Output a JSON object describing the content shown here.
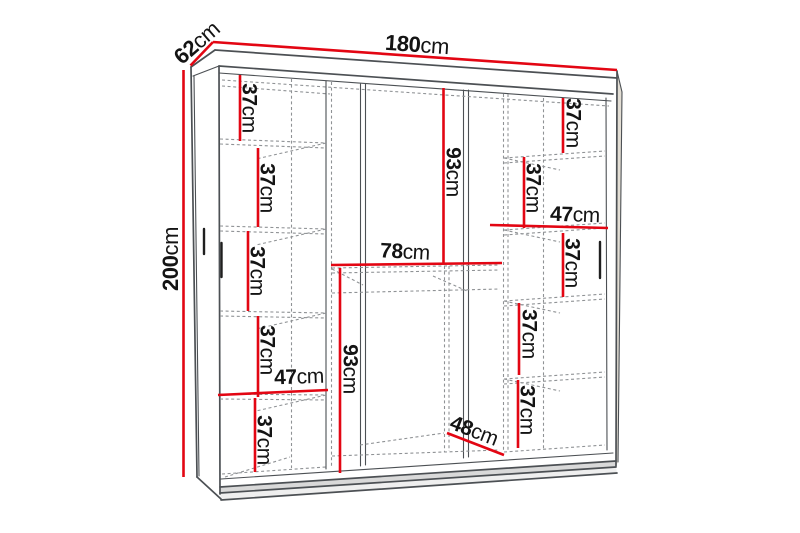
{
  "colors": {
    "dimension_line": "#e30613",
    "outline": "#4c5054",
    "hidden_line": "#8f9295",
    "text": "#141414",
    "background": "#ffffff",
    "handle": "#1f1f1f"
  },
  "dims": {
    "width180": {
      "num": "180",
      "unit": "cm"
    },
    "depth62": {
      "num": "62",
      "unit": "cm"
    },
    "height200": {
      "num": "200",
      "unit": "cm"
    },
    "l37_1": {
      "num": "37",
      "unit": "cm"
    },
    "l37_2": {
      "num": "37",
      "unit": "cm"
    },
    "l37_3": {
      "num": "37",
      "unit": "cm"
    },
    "l37_4": {
      "num": "37",
      "unit": "cm"
    },
    "l47": {
      "num": "47",
      "unit": "cm"
    },
    "l37_5": {
      "num": "37",
      "unit": "cm"
    },
    "m93_top": {
      "num": "93",
      "unit": "cm"
    },
    "m78": {
      "num": "78",
      "unit": "cm"
    },
    "m93_bottom": {
      "num": "93",
      "unit": "cm"
    },
    "m48": {
      "num": "48",
      "unit": "cm"
    },
    "r37_1": {
      "num": "37",
      "unit": "cm"
    },
    "r37_2": {
      "num": "37",
      "unit": "cm"
    },
    "r47": {
      "num": "47",
      "unit": "cm"
    },
    "r37_3": {
      "num": "37",
      "unit": "cm"
    },
    "r37_4": {
      "num": "37",
      "unit": "cm"
    },
    "r37_5": {
      "num": "37",
      "unit": "cm"
    }
  }
}
